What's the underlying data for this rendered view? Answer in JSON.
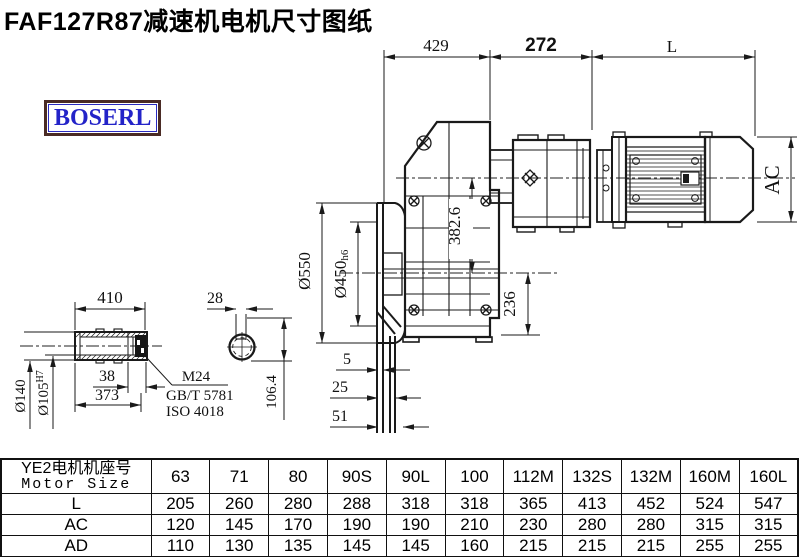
{
  "title": "FAF127R87减速机电机尺寸图纸",
  "logo": {
    "text": "BOSERL"
  },
  "dims": {
    "top": {
      "left": "429",
      "mid": "272",
      "right": "L"
    },
    "main": {
      "motor_height": "AC",
      "axis_distance": "382.6",
      "axis_to_base": "236",
      "flange_od": "Ø550",
      "spigot_d": "Ø450",
      "spigot_tol": "h6",
      "plate1": "5",
      "plate2": "25",
      "plate3": "51"
    },
    "shaft": {
      "length": "410",
      "groove": "38",
      "bore_depth": "373",
      "od": "Ø140",
      "bore": "Ø105",
      "bore_tol": "H7",
      "thread": "M24",
      "std1": "GB/T 5781",
      "std2": "ISO 4018"
    },
    "end_view": {
      "key_width": "28",
      "key_height": "106.4"
    }
  },
  "table": {
    "header_cn": "YE2电机机座号",
    "header_en": "Motor Size",
    "columns": [
      "63",
      "71",
      "80",
      "90S",
      "90L",
      "100",
      "112M",
      "132S",
      "132M",
      "160M",
      "160L"
    ],
    "rows": [
      {
        "label": "L",
        "values": [
          "205",
          "260",
          "280",
          "288",
          "318",
          "318",
          "365",
          "413",
          "452",
          "524",
          "547"
        ]
      },
      {
        "label": "AC",
        "values": [
          "120",
          "145",
          "170",
          "190",
          "190",
          "210",
          "230",
          "280",
          "280",
          "315",
          "315"
        ]
      },
      {
        "label": "AD",
        "values": [
          "110",
          "130",
          "135",
          "145",
          "145",
          "160",
          "215",
          "215",
          "215",
          "255",
          "255"
        ]
      }
    ]
  }
}
